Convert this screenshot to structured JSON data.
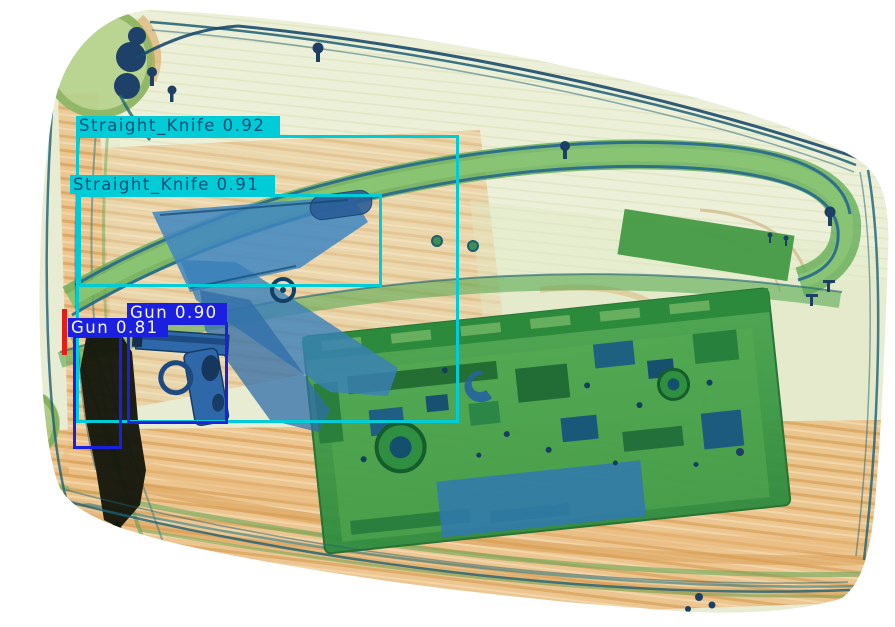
{
  "detections": [
    {
      "label": "Straight_Knife",
      "score": "0.92",
      "text": "Straight_Knife 0.92",
      "color": "#00ccd8",
      "text_color": "#0d4d74",
      "box": {
        "x": 76,
        "y": 135,
        "w": 383,
        "h": 288
      },
      "label_box": {
        "x": 76,
        "y": 116,
        "w": 204,
        "h": 19
      }
    },
    {
      "label": "Straight_Knife",
      "score": "0.91",
      "text": "Straight_Knife 0.91",
      "color": "#00ccd8",
      "text_color": "#0d4d74",
      "box": {
        "x": 78,
        "y": 194,
        "w": 304,
        "h": 93
      },
      "label_box": {
        "x": 70,
        "y": 175,
        "w": 205,
        "h": 19
      }
    },
    {
      "label": "Gun",
      "score": "0.90",
      "text": "Gun 0.90",
      "color": "#1a1fe0",
      "text_color": "#f5f5f5",
      "box": {
        "x": 127,
        "y": 322,
        "w": 101,
        "h": 102
      },
      "label_box": {
        "x": 127,
        "y": 303,
        "w": 100,
        "h": 19
      }
    },
    {
      "label": "Gun",
      "score": "0.81",
      "text": "Gun 0.81",
      "color": "#1a1fe0",
      "text_color": "#f5f5f5",
      "box": {
        "x": 73,
        "y": 335,
        "w": 49,
        "h": 114
      },
      "label_box": {
        "x": 68,
        "y": 318,
        "w": 100,
        "h": 19
      }
    }
  ],
  "artifacts": {
    "red_mark": {
      "x": 62,
      "y": 309,
      "w": 5,
      "h": 46,
      "color": "#e02017"
    }
  },
  "palette": {
    "organic_orange": "#e2a95f",
    "plastic_green": "#61ad55",
    "metal_blue": "#2e68a8",
    "opaque_black": "#14170d",
    "shell_pale": "#e8ecd3"
  }
}
